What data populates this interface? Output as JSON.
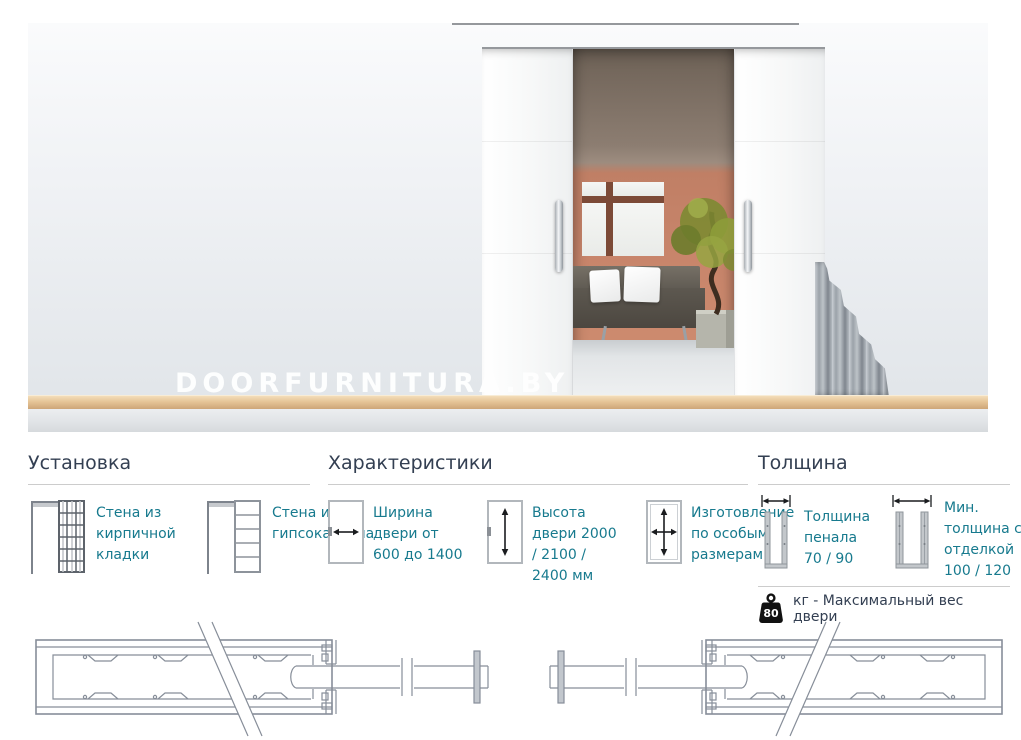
{
  "photo": {
    "watermark": "DOORFURNITURA.BY"
  },
  "sections": {
    "installation": {
      "title": "Установка",
      "items": [
        {
          "icon": "brick-wall-pocket-icon",
          "label": "Стена из кирпичной кладки"
        },
        {
          "icon": "drywall-pocket-icon",
          "label": "Стена из гипсокартона"
        }
      ]
    },
    "characteristics": {
      "title": "Характеристики",
      "items": [
        {
          "icon": "door-width-arrow-icon",
          "label": "Ширина двери от 600 до 1400"
        },
        {
          "icon": "door-height-arrow-icon",
          "label": "Высота двери 2000 / 2100 / 2400 мм"
        },
        {
          "icon": "door-custom-size-icon",
          "label": "Изготовление по особым размерам"
        }
      ]
    },
    "thickness": {
      "title": "Толщина",
      "items": [
        {
          "icon": "cassette-thickness-icon",
          "label": "Толщина пенала 70 / 90"
        },
        {
          "icon": "finished-wall-thickness-icon",
          "label": "Мин. толщина с отделкой 100 / 120"
        }
      ],
      "max_weight": {
        "value": "80",
        "label": "кг - Максимальный вес двери"
      }
    }
  },
  "colors": {
    "heading": "#333f52",
    "body_text": "#177a8e",
    "rule": "#cccccc",
    "terracotta_wall": "#c8856b",
    "baseboard": "#e5c496",
    "drawing_stroke": "#878e99",
    "weight_icon": "#111111"
  }
}
